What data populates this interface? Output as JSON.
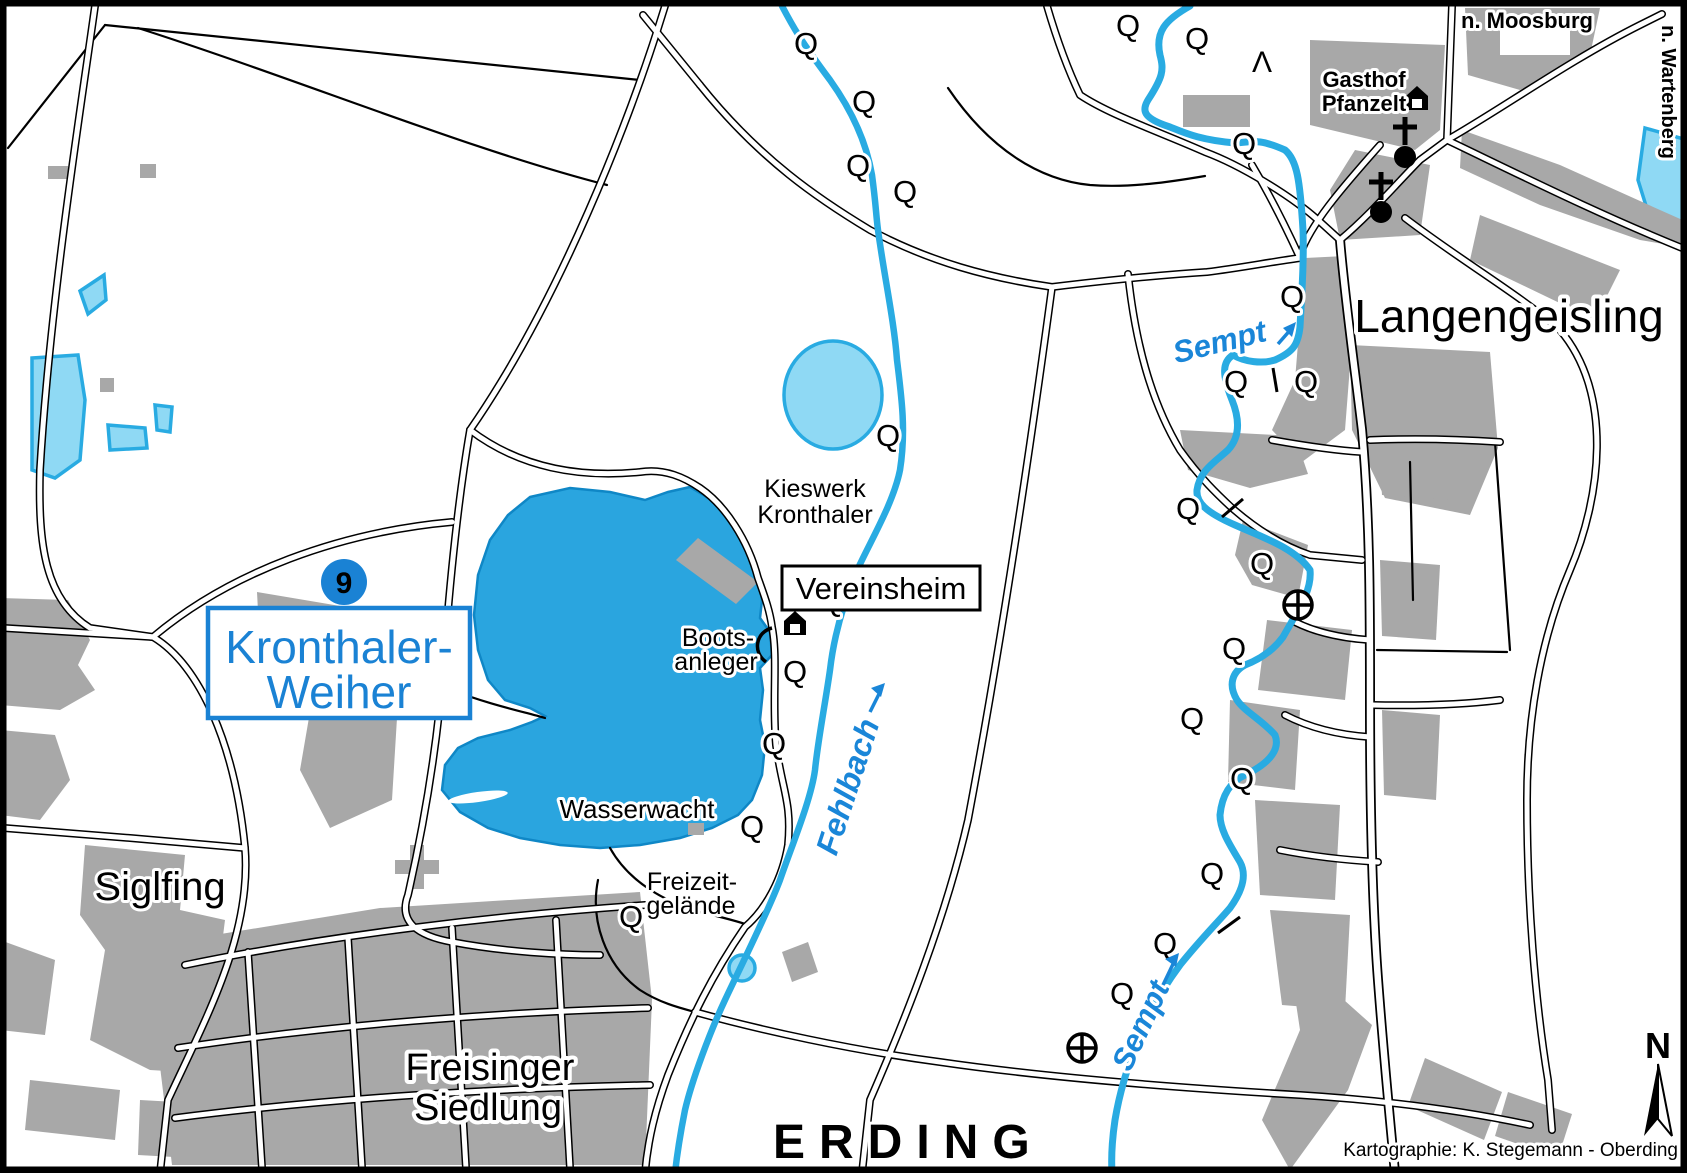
{
  "colors": {
    "lake_fill": "#2aa5df",
    "pond_fill": "#8fd9f4",
    "stream_blue": "#29abe2",
    "label_blue": "#1a82d4",
    "building_gray": "#a8a8a8",
    "ink": "#000000"
  },
  "labels": {
    "lake_badge": "9",
    "lake_name_line1": "Kronthaler-",
    "lake_name_line2": "Weiher",
    "village_siglfing": "Siglfing",
    "settlement_line1": "Freisinger",
    "settlement_line2": "Siedlung",
    "city_erding": "ERDING",
    "village_langengeisling": "Langengeisling",
    "poi_kieswerk_line1": "Kieswerk",
    "poi_kieswerk_line2": "Kronthaler",
    "poi_vereinsheim": "Vereinsheim",
    "poi_boot_line1": "Boots-",
    "poi_boot_line2": "anleger",
    "poi_wasserwacht": "Wasserwacht",
    "poi_freizeit_line1": "Freizeit-",
    "poi_freizeit_line2": "gelände",
    "poi_gasthof_line1": "Gasthof",
    "poi_gasthof_line2": "Pfanzelt",
    "river_sempt_upper": "Sempt",
    "river_sempt_lower": "Sempt",
    "river_fehlbach": "Fehlbach",
    "direction_moosburg": "n. Moosburg",
    "direction_wartenberg": "n. Wartenberg",
    "compass_north": "N",
    "credit": "Kartographie: K. Stegemann - Oberding",
    "spring_symbol": "Q",
    "lambda_symbol": "Λ"
  }
}
